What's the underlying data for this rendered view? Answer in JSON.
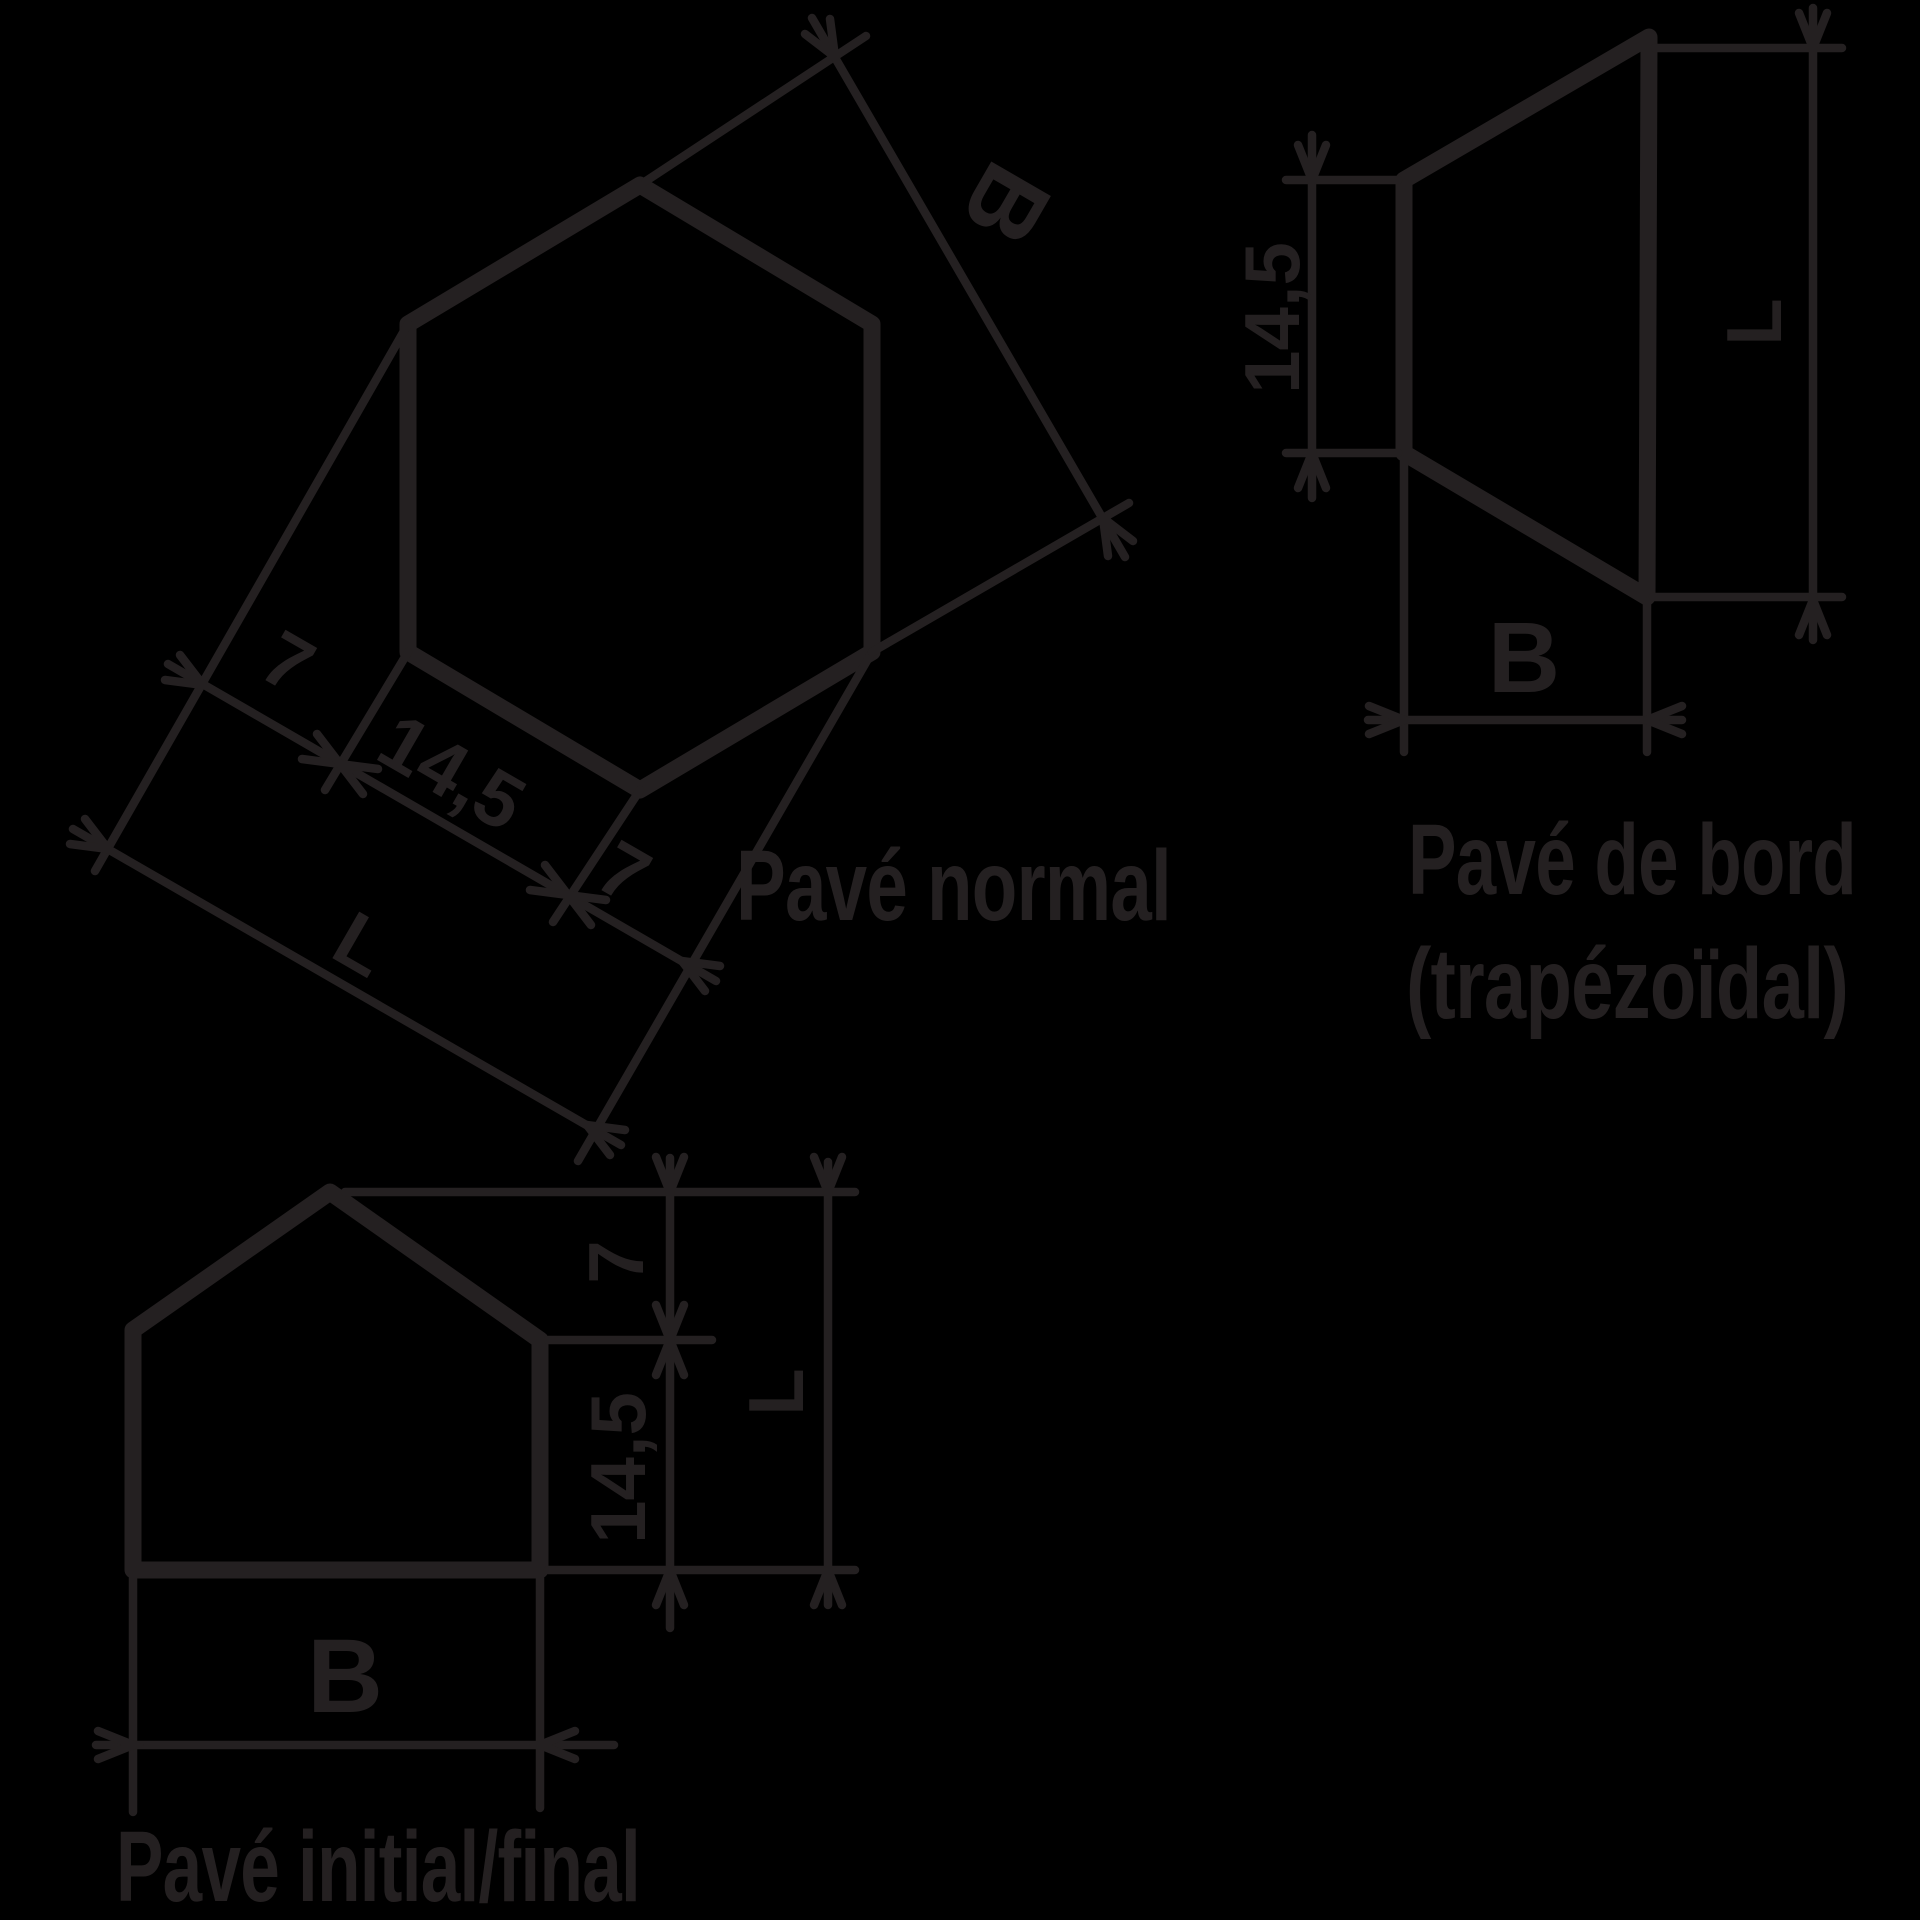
{
  "colors": {
    "background": "#000000",
    "line": "#242021"
  },
  "pave_normal": {
    "caption": "Pavé normal",
    "seg1": "7",
    "seg2": "14,5",
    "seg3": "7",
    "length": "L",
    "width": "B"
  },
  "pave_bord": {
    "caption_line1": "Pavé de bord",
    "caption_line2": "(trapézoïdal)",
    "height": "14,5",
    "length": "L",
    "width": "B"
  },
  "pave_initial": {
    "caption": "Pavé initial/final",
    "top": "7",
    "body": "14,5",
    "length": "L",
    "width": "B"
  }
}
